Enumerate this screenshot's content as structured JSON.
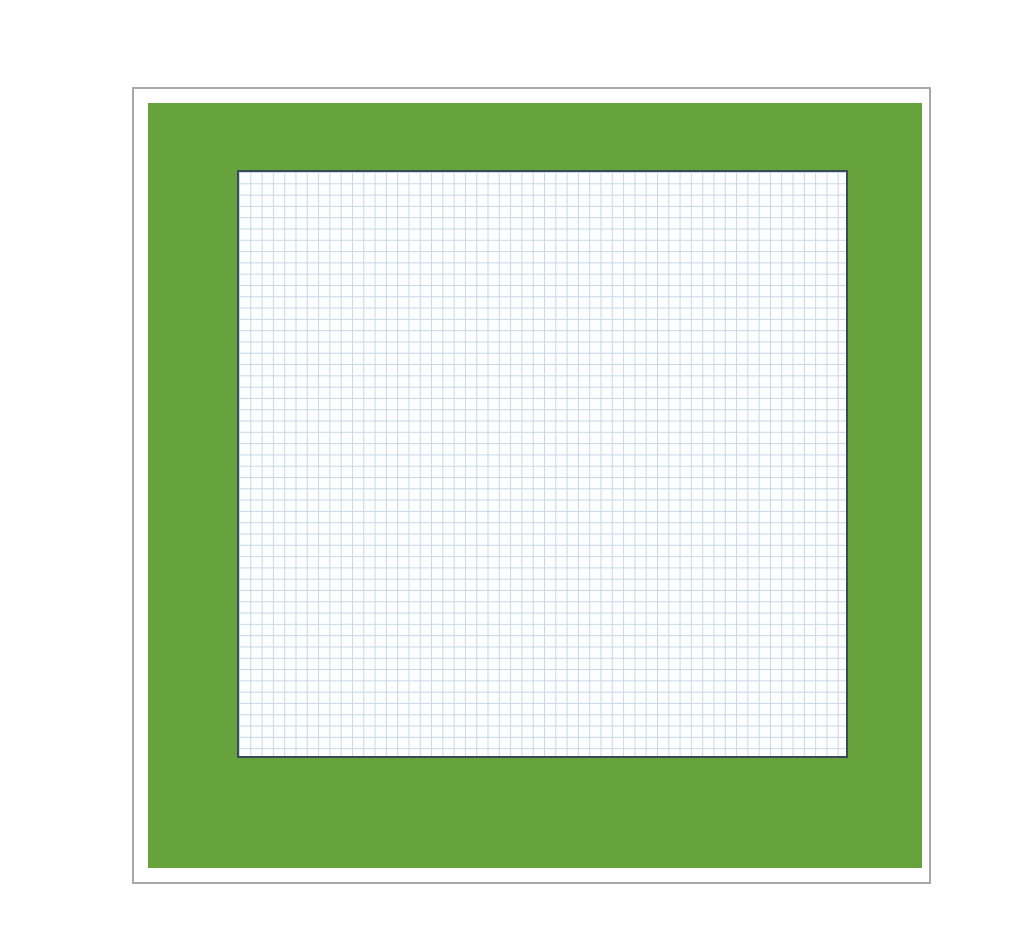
{
  "plan": {
    "labels": {
      "wintergarten": "Wintergarten",
      "geraete": "Geräte",
      "aufzug": "Aufzug",
      "abst_top_left": "Abst.",
      "abst_top_right": "Abst.",
      "zugang": "Zugang überdacht",
      "raum_left": "Raum",
      "raum_right": "Raum",
      "bibliothek": "Bibliothek",
      "abst_bottom": "Abst.",
      "terrasse": "Terrasse"
    },
    "df_label": "DF",
    "df_count": 6,
    "watermark": "( ) imOffice"
  },
  "garden": {
    "bushes": {
      "top": 10,
      "bottom": 10,
      "left": 8,
      "right": 8
    }
  },
  "furniture": [
    {
      "type": "umbrella",
      "x": 258,
      "y": 201
    },
    {
      "type": "dining-set",
      "x": 317,
      "y": 258,
      "orient": "v"
    },
    {
      "type": "dining-set",
      "x": 544,
      "y": 259,
      "orient": "h"
    },
    {
      "type": "round-set",
      "x": 288,
      "y": 654,
      "chairs": 4
    },
    {
      "type": "round-set",
      "x": 719,
      "y": 723,
      "chairs": 2
    },
    {
      "type": "spiral-stair",
      "x": 674,
      "y": 588
    },
    {
      "type": "lounge-chair",
      "x": 417,
      "y": 630
    },
    {
      "type": "desk",
      "x": 521,
      "y": 630
    },
    {
      "type": "desk-chair",
      "x": 495,
      "y": 631
    },
    {
      "type": "sideboard",
      "x": 766,
      "y": 250,
      "w": 74,
      "h": 18
    },
    {
      "type": "sideboard",
      "x": 687,
      "y": 338,
      "w": 60,
      "h": 20
    },
    {
      "type": "sideboard",
      "x": 766,
      "y": 338,
      "w": 74,
      "h": 20
    },
    {
      "type": "cabinet",
      "x": 734,
      "y": 586,
      "w": 18,
      "h": 120
    },
    {
      "type": "plant",
      "x": 390,
      "y": 228
    },
    {
      "type": "plant",
      "x": 700,
      "y": 227
    },
    {
      "type": "plant",
      "x": 831,
      "y": 194
    },
    {
      "type": "plant",
      "x": 268,
      "y": 737
    },
    {
      "type": "plant",
      "x": 530,
      "y": 741
    },
    {
      "type": "plant",
      "x": 822,
      "y": 739
    }
  ],
  "colors": {
    "garden": "#67a33c",
    "wall": "#2e3d4f",
    "room_fill": "#e7ebf0",
    "furniture_blue": "#8fb2d6",
    "furniture_outline": "#3f5a77",
    "tile_line": "#c8d8e4"
  }
}
